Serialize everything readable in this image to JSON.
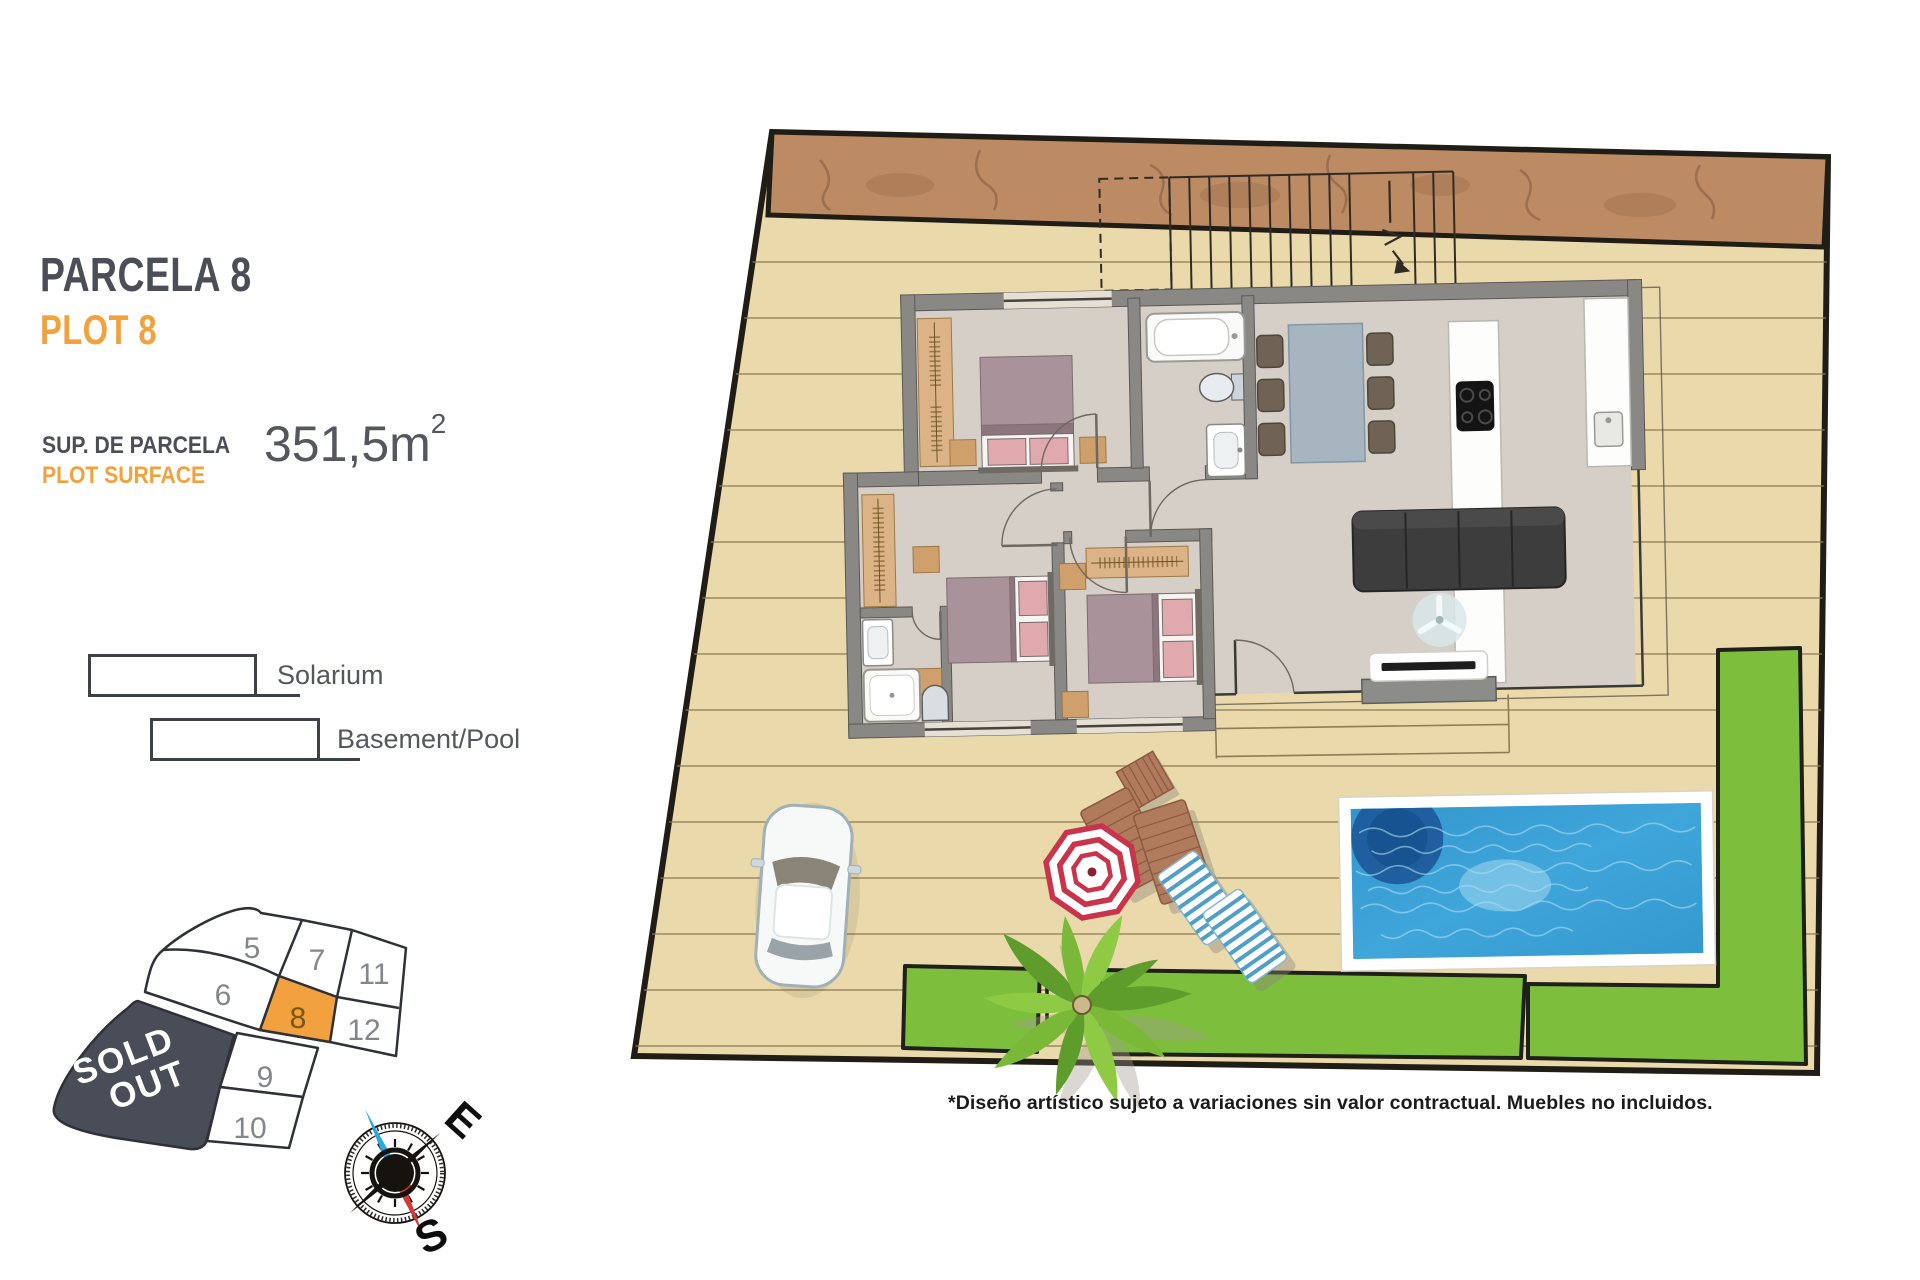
{
  "header": {
    "title_primary": "PARCELA 8",
    "title_secondary": "PLOT 8",
    "surface_label_primary": "SUP. DE PARCELA",
    "surface_label_secondary": "PLOT SURFACE",
    "surface_value": "351,5m",
    "surface_exponent": "2"
  },
  "legend": {
    "items": [
      {
        "label": "Solarium"
      },
      {
        "label": "Basement/Pool"
      }
    ]
  },
  "plot_map": {
    "sold_out_lines": [
      "SOLD",
      "OUT"
    ],
    "highlighted_plot": "8",
    "plots": [
      {
        "number": "5"
      },
      {
        "number": "7"
      },
      {
        "number": "11"
      },
      {
        "number": "6"
      },
      {
        "number": "8"
      },
      {
        "number": "12"
      },
      {
        "number": "9"
      },
      {
        "number": "10"
      }
    ]
  },
  "compass": {
    "east": "E",
    "south": "S"
  },
  "disclaimer": "*Diseño artístico sujeto a variaciones sin valor contractual. Muebles no incluidos.",
  "colors": {
    "accent_orange": "#F2A13F",
    "dark_slate": "#4A4E57",
    "sold_out_bg": "#494D58",
    "lawn_green": "#7DBF3C",
    "pool_blue": "#379FD4",
    "deck_tan": "#EAD9AB",
    "soil_brown": "#BC8A63",
    "wall_gray": "#8A8884"
  }
}
